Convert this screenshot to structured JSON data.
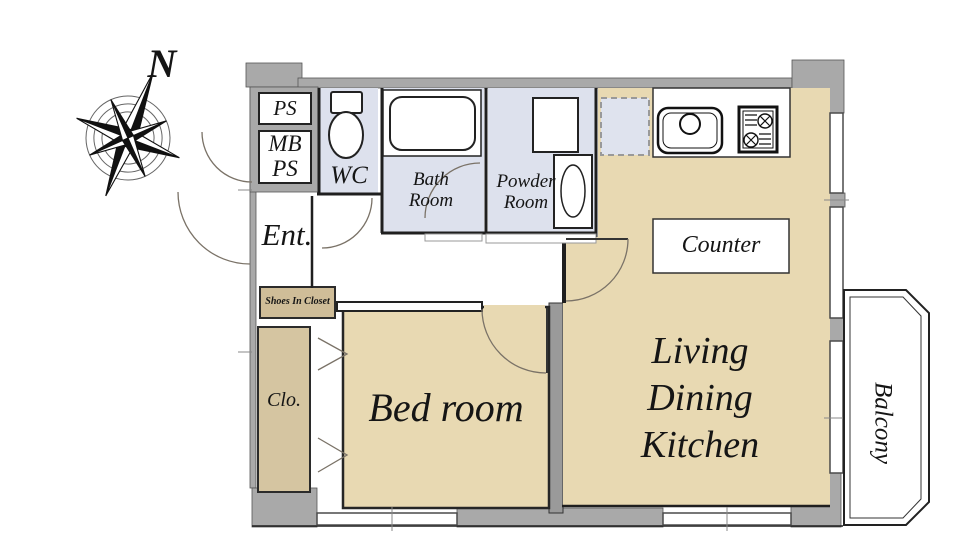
{
  "title": "apartment-floor-plan",
  "palette": {
    "room_beige": "#e8d9b2",
    "wet_room_lavender": "#dde1ed",
    "closet_tan": "#d5c5a1",
    "shoes_box_tan": "#cfbd98",
    "wall_gray": "#a9a9a9",
    "divider_gray": "#9a9a9a",
    "line_dark": "#1f1f1f",
    "arc_brown": "#7a7267",
    "background": "#ffffff"
  },
  "compass": {
    "north_label": "N"
  },
  "rooms": {
    "ps": {
      "label": "PS"
    },
    "mb_ps": {
      "line1": "MB",
      "line2": "PS"
    },
    "wc": {
      "label": "WC"
    },
    "bath": {
      "line1": "Bath",
      "line2": "Room"
    },
    "powder": {
      "line1": "Powder",
      "line2": "Room"
    },
    "entrance": {
      "label": "Ent."
    },
    "shoes_closet": {
      "label": "Shoes In Closet"
    },
    "closet": {
      "label": "Clo."
    },
    "bedroom": {
      "label": "Bed room"
    },
    "ldk": {
      "line1": "Living",
      "line2": "Dining",
      "line3": "Kitchen"
    },
    "counter": {
      "label": "Counter"
    },
    "balcony": {
      "label": "Balcony"
    }
  }
}
